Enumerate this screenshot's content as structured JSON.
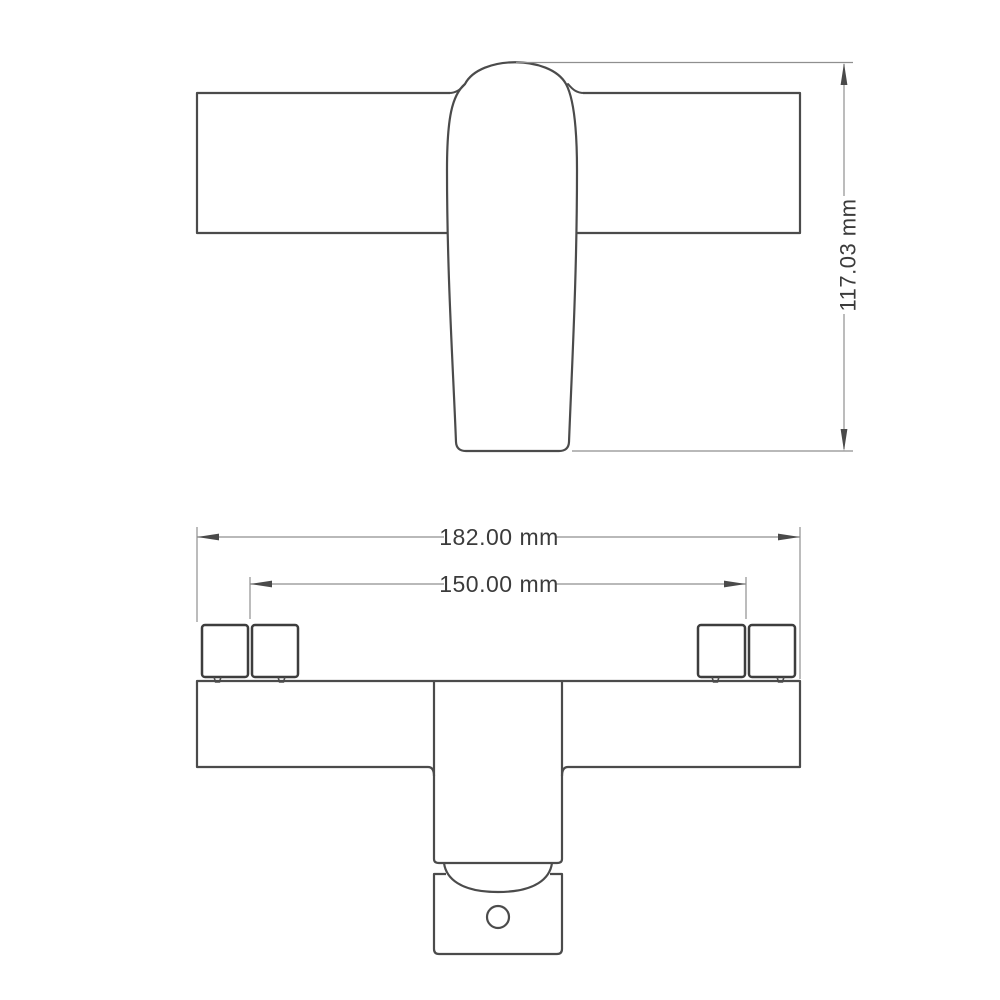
{
  "drawing": {
    "description": "faucet two-view dimension drawing",
    "colors": {
      "background": "#ffffff",
      "outline": "#4b4b4b",
      "outline_bold": "#3d3d3d",
      "dimension_line": "#8f8f8f",
      "arrow": "#4a4a4a",
      "text": "#3b3b3b"
    },
    "front_view": {
      "height_dimension": "117.03 mm"
    },
    "bottom_view": {
      "overall_width_dimension": "182.00 mm",
      "connector_spacing_dimension": "150.00 mm"
    }
  }
}
